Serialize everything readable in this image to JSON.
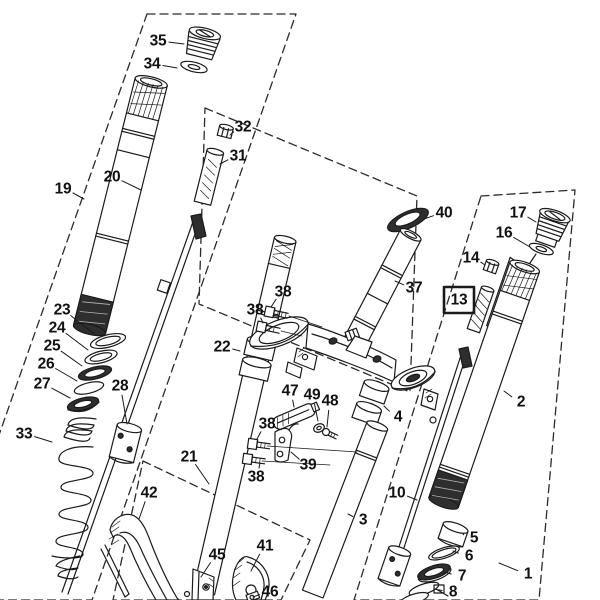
{
  "figure": {
    "type": "exploded-parts-diagram",
    "highlighted_part": "13"
  },
  "colors": {
    "background": "#ffffff",
    "line": "#1a1a1a",
    "highlight": "#e8000d"
  },
  "callouts": [
    {
      "num": "35",
      "x": 158,
      "y": 41,
      "tx": 184,
      "ty": 44,
      "highlight": false
    },
    {
      "num": "34",
      "x": 152,
      "y": 64,
      "tx": 177,
      "ty": 68,
      "highlight": false
    },
    {
      "num": "20",
      "x": 112,
      "y": 177,
      "tx": 141,
      "ty": 190,
      "highlight": false
    },
    {
      "num": "19",
      "x": 63,
      "y": 189,
      "tx": 84,
      "ty": 199,
      "highlight": false
    },
    {
      "num": "32",
      "x": 243,
      "y": 127,
      "tx": 230,
      "ty": 135,
      "highlight": false
    },
    {
      "num": "31",
      "x": 238,
      "y": 156,
      "tx": 220,
      "ty": 164,
      "highlight": false
    },
    {
      "num": "38",
      "x": 283,
      "y": 292,
      "tx": 271,
      "ty": 307,
      "highlight": false
    },
    {
      "num": "38",
      "x": 255,
      "y": 310,
      "tx": 263,
      "ty": 323,
      "highlight": false
    },
    {
      "num": "40",
      "x": 444,
      "y": 213,
      "tx": 424,
      "ty": 219,
      "highlight": false
    },
    {
      "num": "37",
      "x": 414,
      "y": 288,
      "tx": 395,
      "ty": 281,
      "highlight": false
    },
    {
      "num": "17",
      "x": 518,
      "y": 213,
      "tx": 536,
      "ty": 222,
      "highlight": false
    },
    {
      "num": "16",
      "x": 504,
      "y": 233,
      "tx": 530,
      "ty": 247,
      "highlight": false
    },
    {
      "num": "14",
      "x": 471,
      "y": 258,
      "tx": 485,
      "ty": 265,
      "highlight": false
    },
    {
      "num": "13",
      "x": 459,
      "y": 300,
      "tx": 476,
      "ty": 306,
      "highlight": true
    },
    {
      "num": "2",
      "x": 521,
      "y": 402,
      "tx": 504,
      "ty": 391,
      "highlight": false
    },
    {
      "num": "23",
      "x": 62,
      "y": 310,
      "tx": 94,
      "ty": 334,
      "highlight": false
    },
    {
      "num": "24",
      "x": 57,
      "y": 328,
      "tx": 88,
      "ty": 350,
      "highlight": false
    },
    {
      "num": "25",
      "x": 52,
      "y": 346,
      "tx": 82,
      "ty": 366,
      "highlight": false
    },
    {
      "num": "26",
      "x": 46,
      "y": 364,
      "tx": 77,
      "ty": 381,
      "highlight": false
    },
    {
      "num": "27",
      "x": 42,
      "y": 384,
      "tx": 70,
      "ty": 398,
      "highlight": false
    },
    {
      "num": "33",
      "x": 24,
      "y": 434,
      "tx": 52,
      "ty": 442,
      "highlight": false
    },
    {
      "num": "28",
      "x": 120,
      "y": 386,
      "tx": 127,
      "ty": 424,
      "highlight": false
    },
    {
      "num": "22",
      "x": 222,
      "y": 347,
      "tx": 240,
      "ty": 351,
      "highlight": false
    },
    {
      "num": "21",
      "x": 189,
      "y": 457,
      "tx": 209,
      "ty": 484,
      "highlight": false
    },
    {
      "num": "42",
      "x": 149,
      "y": 493,
      "tx": 139,
      "ty": 519,
      "highlight": false
    },
    {
      "num": "47",
      "x": 290,
      "y": 391,
      "tx": 294,
      "ty": 407,
      "highlight": false
    },
    {
      "num": "49",
      "x": 312,
      "y": 395,
      "tx": 318,
      "ty": 421,
      "highlight": false
    },
    {
      "num": "48",
      "x": 330,
      "y": 401,
      "tx": 327,
      "ty": 427,
      "highlight": false
    },
    {
      "num": "38",
      "x": 267,
      "y": 424,
      "tx": 257,
      "ty": 439,
      "highlight": false
    },
    {
      "num": "38",
      "x": 256,
      "y": 477,
      "tx": 260,
      "ty": 463,
      "highlight": false
    },
    {
      "num": "39",
      "x": 308,
      "y": 465,
      "tx": 291,
      "ty": 452,
      "highlight": false
    },
    {
      "num": "4",
      "x": 398,
      "y": 417,
      "tx": 384,
      "ty": 406,
      "highlight": false
    },
    {
      "num": "10",
      "x": 397,
      "y": 493,
      "tx": 417,
      "ty": 500,
      "highlight": false
    },
    {
      "num": "3",
      "x": 363,
      "y": 520,
      "tx": 348,
      "ty": 514,
      "highlight": false
    },
    {
      "num": "5",
      "x": 474,
      "y": 538,
      "tx": 463,
      "ty": 534,
      "highlight": false
    },
    {
      "num": "6",
      "x": 469,
      "y": 556,
      "tx": 453,
      "ty": 551,
      "highlight": false
    },
    {
      "num": "7",
      "x": 462,
      "y": 576,
      "tx": 444,
      "ty": 572,
      "highlight": false
    },
    {
      "num": "8",
      "x": 453,
      "y": 592,
      "tx": 434,
      "ty": 589,
      "highlight": false
    },
    {
      "num": "1",
      "x": 528,
      "y": 574,
      "tx": 499,
      "ty": 563,
      "highlight": false
    },
    {
      "num": "45",
      "x": 217,
      "y": 555,
      "tx": 201,
      "ty": 577,
      "highlight": false
    },
    {
      "num": "41",
      "x": 265,
      "y": 546,
      "tx": 251,
      "ty": 571,
      "highlight": false
    },
    {
      "num": "46",
      "x": 270,
      "y": 592,
      "tx": 253,
      "ty": 597,
      "highlight": false
    }
  ]
}
